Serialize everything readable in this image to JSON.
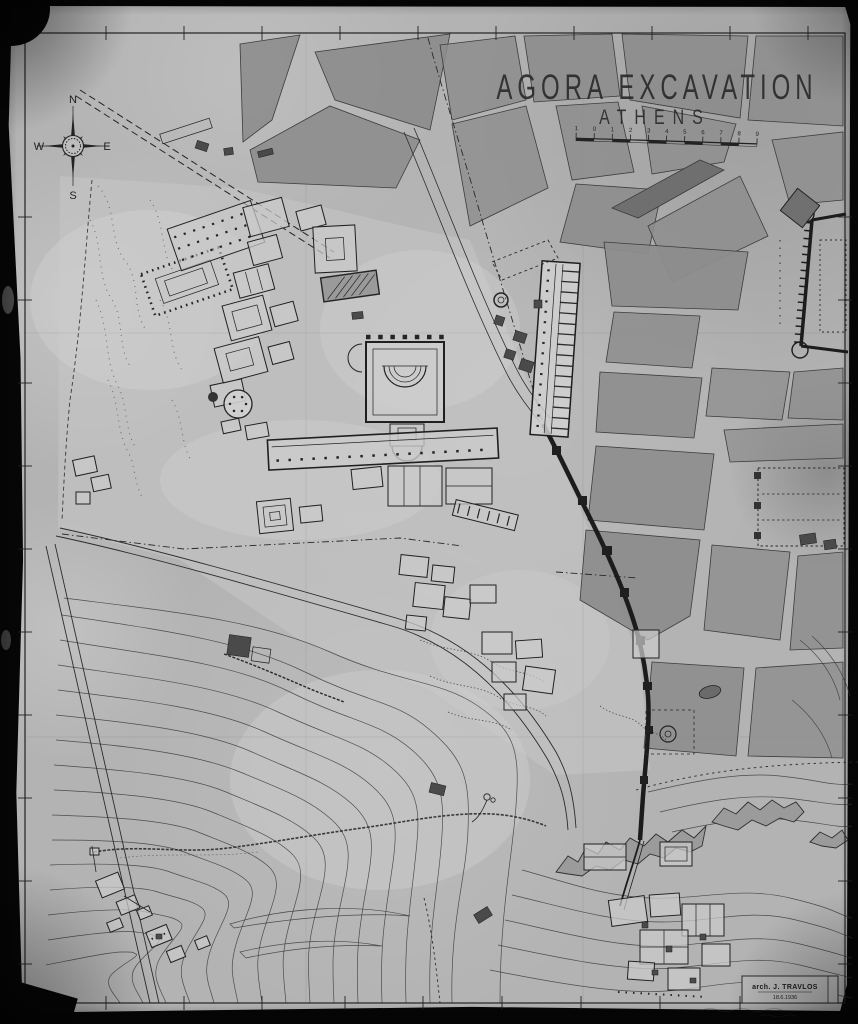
{
  "title_block": {
    "title": "AGORA EXCAVATION",
    "subtitle": "ATHENS"
  },
  "scale_bar": {
    "labels": [
      "1",
      "0",
      "1",
      "2",
      "3",
      "4",
      "5",
      "6",
      "7",
      "8",
      "9"
    ]
  },
  "compass": {
    "north": "N",
    "east": "E",
    "south": "S",
    "west": "W"
  },
  "signature": {
    "credit": "arch. J. TRAVLOS",
    "date": "18.6.1936"
  },
  "colors": {
    "photo_background": "#060606",
    "paper": "#b3b3b3",
    "ink": "#242424",
    "city_block_fill": "#8d8d8d",
    "building_fill": "#cbcbcb",
    "contour_ink": "#3a3a3a"
  }
}
